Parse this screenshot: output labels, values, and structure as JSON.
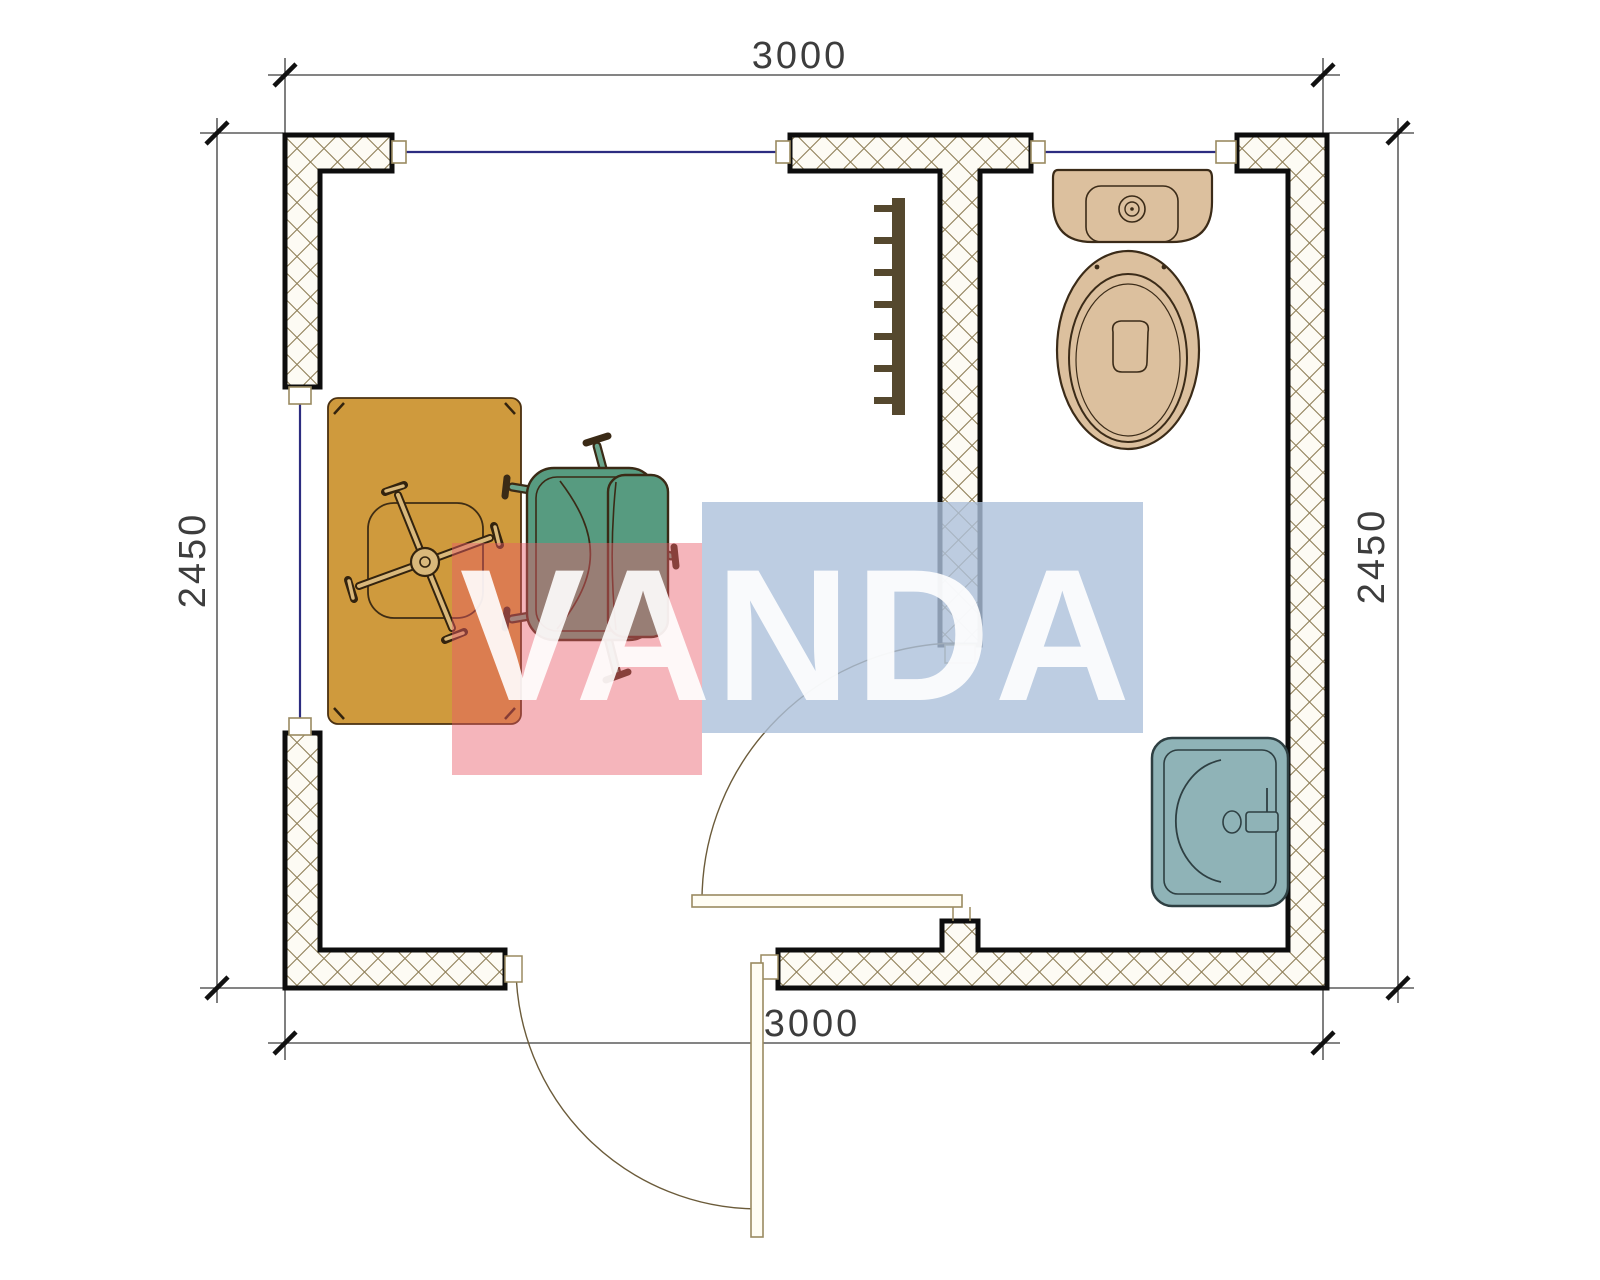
{
  "plan": {
    "dimensions": {
      "top": "3000",
      "bottom": "3000",
      "left": "2450",
      "right": "2450"
    },
    "watermark": {
      "text": "VANDA",
      "red_fill": "rgba(233,90,105,0.45)",
      "blue_fill": "rgba(173,193,219,0.80)",
      "red_hex": "#e95a69",
      "blue_hex": "#adc1db"
    },
    "colors": {
      "desk": "#cf9a3d",
      "armchair": "#579b80",
      "armchair_leg": "#6aa58c",
      "chair_base": "#d9b87b",
      "toilet": "#dcc09e",
      "sink": "#8fb3b7",
      "radiator": "#55482e",
      "window_line": "#2c2c80",
      "hatch_line": "#8f7f58",
      "wall_outline": "#0d0d0d"
    }
  }
}
